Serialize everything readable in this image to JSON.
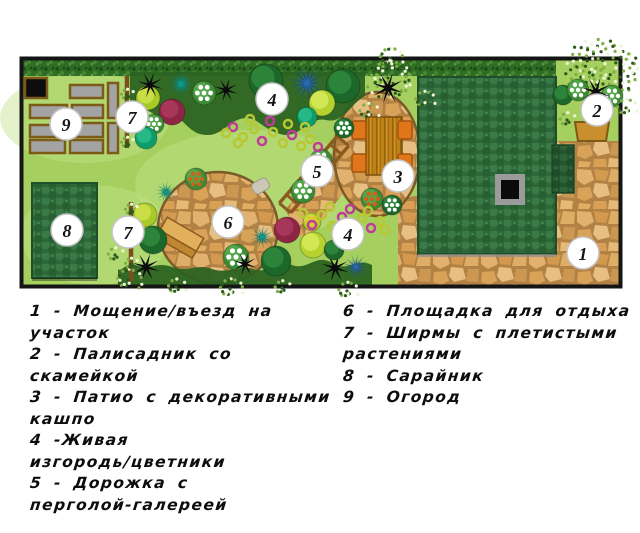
{
  "legend": {
    "left_lines": [
      "1 - Мощение/въезд на",
      "участок",
      "2 - Палисадник со",
      "скамейкой",
      "3 - Патио с декоративными",
      "кашпо",
      "4 -Живая",
      "изгородь/цветники",
      "5 - Дорожка с",
      "перголой-галереей"
    ],
    "right_lines": [
      "6 - Площадка для отдыха",
      "7 - Ширмы с плетистыми",
      "растениями",
      "8 - Сарайник",
      "9 - Огород"
    ]
  },
  "plan": {
    "colors": {
      "lawn": "#a5cf5e",
      "lawnLight": "#c3e28c",
      "foliageBand": "#2b6322",
      "pergola": "#8a5a20",
      "trellis": "#7a4f1e",
      "border": "#151515",
      "bedFill": "#a3a3a3",
      "bedBlack": "#0d0d0d",
      "bedStroke": "#7c5b16",
      "bench2Fill": "#c98f2e",
      "bench2Stroke": "#7d5a17",
      "chairFill": "#e0761c",
      "chairStroke": "#a3540c",
      "tableStroke": "#7a4f10",
      "roofStroke": "#1e4f2a",
      "stoneStroke": "#7a5a2a",
      "markerFill": "#ffffff",
      "markerStroke": "#c4c4c4",
      "markerText": "#151515",
      "chimneyFrame": "#9b9b9b",
      "chimneyCore": "#0b0b0b",
      "stoneStep": "#ccc7b8",
      "flowerMagenta": "#c23a97",
      "flowerGreen": "#b8c832",
      "speckleDots": [
        "#2c5a1d",
        "#7fae45",
        "#edf5d6"
      ],
      "palette": {
        "darkTree": [
          "#1c672a",
          "#2f8a3e"
        ],
        "limeTree": [
          "#a9c929",
          "#cfe24b"
        ],
        "ygTree": [
          "#b5d22e",
          "#d6eb59"
        ],
        "tealBush": [
          "#0f9c6b",
          "#2abd8b"
        ],
        "tealPalm": [
          "#0c7a6a",
          "#12998a"
        ],
        "bluePalm": [
          "#1b4f86",
          "#2a6aa8"
        ],
        "redBush": [
          "#8e2544",
          "#aa3a5e"
        ],
        "greenBush": [
          "#3c8c35",
          "#57aa4d"
        ]
      },
      "dots": {
        "whiteDot": "#ffffff",
        "orangeDot": "#d2601a",
        "yellowDot": "#e2c52e"
      }
    },
    "border": [
      21.5,
      58.5,
      599,
      228
    ],
    "lawn": [
      22,
      59,
      598,
      226
    ],
    "lightPatches": [
      [
        85,
        118,
        85,
        45
      ],
      [
        95,
        235,
        75,
        50
      ],
      [
        250,
        185,
        115,
        55
      ]
    ],
    "frontGarden": [
      556,
      59,
      64,
      83
    ],
    "pavings": [
      [
        556,
        141,
        64,
        145
      ],
      [
        398,
        251,
        222,
        35
      ],
      [
        398,
        196,
        22,
        58
      ]
    ],
    "stoneBand": "285,210 335,150 360,172 305,242",
    "patio": [
      377,
      154,
      43,
      62
    ],
    "circle6": [
      218,
      228,
      60,
      56
    ],
    "steppingStone": {
      "x": 252,
      "y": 180,
      "w": 17,
      "h": 12,
      "rot": -30
    },
    "hedge": [
      23,
      59,
      533,
      17
    ],
    "foliageBands": [
      "M130,72 L365,72 L365,96 C350,104 344,124 326,120 C308,116 300,140 280,134 C260,128 256,114 240,119 C225,124 220,139 200,134 C185,130 180,110 163,115 C151,118 142,101 130,105 Z",
      "M118,285 L372,285 L372,265 C356,257 348,273 332,263 C316,253 308,271 292,265 C276,259 270,275 252,269 C236,263 230,275 212,269 C196,263 190,273 172,267 C156,261 150,271 136,265 C126,261 122,273 118,269 Z"
    ],
    "house": [
      418,
      77,
      138,
      177
    ],
    "houseExt": [
      552,
      145,
      22,
      48
    ],
    "chimney": {
      "outer": [
        495,
        174,
        30,
        31
      ],
      "inner": [
        501,
        180,
        18,
        19
      ]
    },
    "shed": [
      32,
      183,
      65,
      95
    ],
    "beds": [
      [
        25,
        78,
        22,
        20,
        "black"
      ],
      [
        70,
        85,
        33,
        13
      ],
      [
        108,
        83,
        10,
        35
      ],
      [
        30,
        105,
        37,
        13
      ],
      [
        72,
        105,
        31,
        13
      ],
      [
        30,
        125,
        37,
        12
      ],
      [
        72,
        123,
        31,
        14
      ],
      [
        30,
        140,
        35,
        13
      ],
      [
        70,
        140,
        33,
        13
      ],
      [
        108,
        123,
        10,
        30
      ]
    ],
    "bench2": "575,122 609,122 606,141 578,141",
    "bench6": {
      "rot": 30,
      "cx": 179,
      "cy": 239,
      "rects": [
        [
          158,
          226,
          42,
          15,
          "#e2b05a"
        ],
        [
          158,
          241,
          42,
          8,
          "#bf8830"
        ]
      ]
    },
    "table": [
      366,
      117,
      36,
      58
    ],
    "chairs": [
      [
        352,
        121,
        14,
        18
      ],
      [
        398,
        121,
        14,
        18
      ],
      [
        352,
        154,
        14,
        18
      ],
      [
        398,
        154,
        14,
        18
      ]
    ],
    "pergola": {
      "x1": 285,
      "y1": 208,
      "x2": 343,
      "y2": 141,
      "w": 15,
      "rungs": 8
    },
    "trellises": [
      [
        127,
        76,
        148
      ],
      [
        131,
        202,
        283
      ]
    ],
    "plants": [
      {
        "t": "speckle",
        "x": 390,
        "y": 58,
        "r": 14
      },
      {
        "t": "tree",
        "c": "limeTree",
        "x": 148,
        "y": 98,
        "r": 12
      },
      {
        "t": "star",
        "x": 150,
        "y": 85,
        "r": 13
      },
      {
        "t": "palm",
        "c": "tealPalm",
        "x": 181,
        "y": 84,
        "r": 15
      },
      {
        "t": "tree",
        "c": "redBush",
        "x": 172,
        "y": 112,
        "r": 13
      },
      {
        "t": "bushd",
        "c": "greenBush",
        "d": "whiteDot",
        "x": 154,
        "y": 124,
        "r": 10
      },
      {
        "t": "tree",
        "c": "tealBush",
        "x": 146,
        "y": 138,
        "r": 11
      },
      {
        "t": "bushd",
        "c": "greenBush",
        "d": "whiteDot",
        "x": 204,
        "y": 93,
        "r": 12
      },
      {
        "t": "star",
        "x": 226,
        "y": 90,
        "r": 12
      },
      {
        "t": "tree",
        "c": "darkTree",
        "x": 266,
        "y": 81,
        "r": 17
      },
      {
        "t": "palm",
        "c": "bluePalm",
        "x": 307,
        "y": 83,
        "r": 19
      },
      {
        "t": "tree",
        "c": "darkTree",
        "x": 343,
        "y": 86,
        "r": 17
      },
      {
        "t": "tree",
        "c": "ygTree",
        "x": 322,
        "y": 103,
        "r": 13
      },
      {
        "t": "tree",
        "c": "tealBush",
        "x": 307,
        "y": 117,
        "r": 10
      },
      {
        "t": "speckle",
        "x": 388,
        "y": 78,
        "r": 24
      },
      {
        "t": "star",
        "x": 388,
        "y": 88,
        "r": 16
      },
      {
        "t": "speckle",
        "x": 424,
        "y": 100,
        "r": 12
      },
      {
        "t": "speckle",
        "x": 368,
        "y": 112,
        "r": 12
      },
      {
        "t": "speckle",
        "x": 601,
        "y": 70,
        "r": 38
      },
      {
        "t": "tree",
        "c": "darkTree",
        "x": 563,
        "y": 95,
        "r": 10
      },
      {
        "t": "bushd",
        "c": "greenBush",
        "d": "whiteDot",
        "x": 578,
        "y": 90,
        "r": 11
      },
      {
        "t": "bushd",
        "c": "greenBush",
        "d": "whiteDot",
        "x": 612,
        "y": 96,
        "r": 11
      },
      {
        "t": "star",
        "x": 596,
        "y": 92,
        "r": 15
      },
      {
        "t": "speckle",
        "x": 567,
        "y": 120,
        "r": 10
      },
      {
        "t": "speckle",
        "x": 626,
        "y": 108,
        "r": 12
      },
      {
        "t": "bushd",
        "c": "greenBush",
        "d": "orangeDot",
        "x": 372,
        "y": 199,
        "r": 11
      },
      {
        "t": "bushd",
        "c": "darkTree",
        "d": "whiteDot",
        "x": 392,
        "y": 205,
        "r": 10
      },
      {
        "t": "bushd",
        "c": "greenBush",
        "d": "whiteDot",
        "x": 321,
        "y": 160,
        "r": 11
      },
      {
        "t": "bushd",
        "c": "greenBush",
        "d": "whiteDot",
        "x": 303,
        "y": 191,
        "r": 12
      },
      {
        "t": "bushd",
        "c": "darkTree",
        "d": "whiteDot",
        "x": 344,
        "y": 128,
        "r": 10
      },
      {
        "t": "bushd",
        "c": "greenBush",
        "d": "orangeDot",
        "x": 196,
        "y": 179,
        "r": 11
      },
      {
        "t": "palm",
        "c": "tealPalm",
        "x": 166,
        "y": 192,
        "r": 11
      },
      {
        "t": "tree",
        "c": "limeTree",
        "x": 145,
        "y": 215,
        "r": 12
      },
      {
        "t": "tree",
        "c": "darkTree",
        "x": 153,
        "y": 240,
        "r": 14
      },
      {
        "t": "star",
        "x": 146,
        "y": 267,
        "r": 14
      },
      {
        "t": "speckle",
        "x": 128,
        "y": 280,
        "r": 15
      },
      {
        "t": "speckle",
        "x": 115,
        "y": 255,
        "r": 10
      },
      {
        "t": "speckle",
        "x": 176,
        "y": 287,
        "r": 11
      },
      {
        "t": "bushd",
        "c": "greenBush",
        "d": "whiteDot",
        "x": 236,
        "y": 257,
        "r": 13
      },
      {
        "t": "star",
        "x": 245,
        "y": 264,
        "r": 12
      },
      {
        "t": "palm",
        "c": "tealPalm",
        "x": 262,
        "y": 237,
        "r": 12
      },
      {
        "t": "tree",
        "c": "redBush",
        "x": 287,
        "y": 230,
        "r": 13
      },
      {
        "t": "tree",
        "c": "darkTree",
        "x": 276,
        "y": 261,
        "r": 15
      },
      {
        "t": "tree",
        "c": "ygTree",
        "x": 313,
        "y": 245,
        "r": 13
      },
      {
        "t": "bushd",
        "c": "limeTree",
        "d": "yellowDot",
        "x": 312,
        "y": 222,
        "r": 9
      },
      {
        "t": "star",
        "x": 335,
        "y": 268,
        "r": 14
      },
      {
        "t": "palm",
        "c": "bluePalm",
        "x": 356,
        "y": 267,
        "r": 13
      },
      {
        "t": "tree",
        "c": "darkTree",
        "x": 334,
        "y": 250,
        "r": 10
      },
      {
        "t": "speckle",
        "x": 230,
        "y": 289,
        "r": 14
      },
      {
        "t": "speckle",
        "x": 347,
        "y": 291,
        "r": 12
      },
      {
        "t": "speckle",
        "x": 282,
        "y": 288,
        "r": 10
      },
      {
        "t": "speckle",
        "x": 127,
        "y": 95,
        "r": 8
      },
      {
        "t": "speckle",
        "x": 127,
        "y": 120,
        "r": 8
      },
      {
        "t": "speckle",
        "x": 127,
        "y": 143,
        "r": 8
      },
      {
        "t": "speckle",
        "x": 131,
        "y": 210,
        "r": 8
      },
      {
        "t": "speckle",
        "x": 131,
        "y": 238,
        "r": 8
      },
      {
        "t": "speckle",
        "x": 131,
        "y": 264,
        "r": 8
      }
    ],
    "flowers": [
      [
        233,
        127,
        "m"
      ],
      [
        243,
        137,
        "g"
      ],
      [
        254,
        129,
        "g"
      ],
      [
        262,
        141,
        "m"
      ],
      [
        273,
        132,
        "g"
      ],
      [
        283,
        143,
        "g"
      ],
      [
        292,
        135,
        "m"
      ],
      [
        301,
        146,
        "g"
      ],
      [
        310,
        139,
        "g"
      ],
      [
        318,
        147,
        "m"
      ],
      [
        288,
        124,
        "g"
      ],
      [
        270,
        121,
        "m"
      ],
      [
        305,
        127,
        "g"
      ],
      [
        250,
        119,
        "g"
      ],
      [
        238,
        143,
        "g"
      ],
      [
        226,
        133,
        "g"
      ],
      [
        303,
        213,
        "g"
      ],
      [
        312,
        225,
        "m"
      ],
      [
        322,
        215,
        "g"
      ],
      [
        332,
        226,
        "g"
      ],
      [
        342,
        217,
        "m"
      ],
      [
        352,
        227,
        "g"
      ],
      [
        362,
        218,
        "g"
      ],
      [
        371,
        228,
        "m"
      ],
      [
        380,
        221,
        "g"
      ],
      [
        330,
        207,
        "g"
      ],
      [
        350,
        209,
        "m"
      ],
      [
        368,
        211,
        "g"
      ],
      [
        385,
        230,
        "g"
      ]
    ],
    "markers": [
      [
        "1",
        583,
        253
      ],
      [
        "2",
        597,
        110
      ],
      [
        "3",
        398,
        176
      ],
      [
        "4",
        272,
        99
      ],
      [
        "4",
        348,
        234
      ],
      [
        "5",
        317,
        171
      ],
      [
        "6",
        228,
        222
      ],
      [
        "7",
        132,
        117
      ],
      [
        "7",
        128,
        232
      ],
      [
        "8",
        67,
        230
      ],
      [
        "9",
        66,
        124
      ]
    ]
  }
}
